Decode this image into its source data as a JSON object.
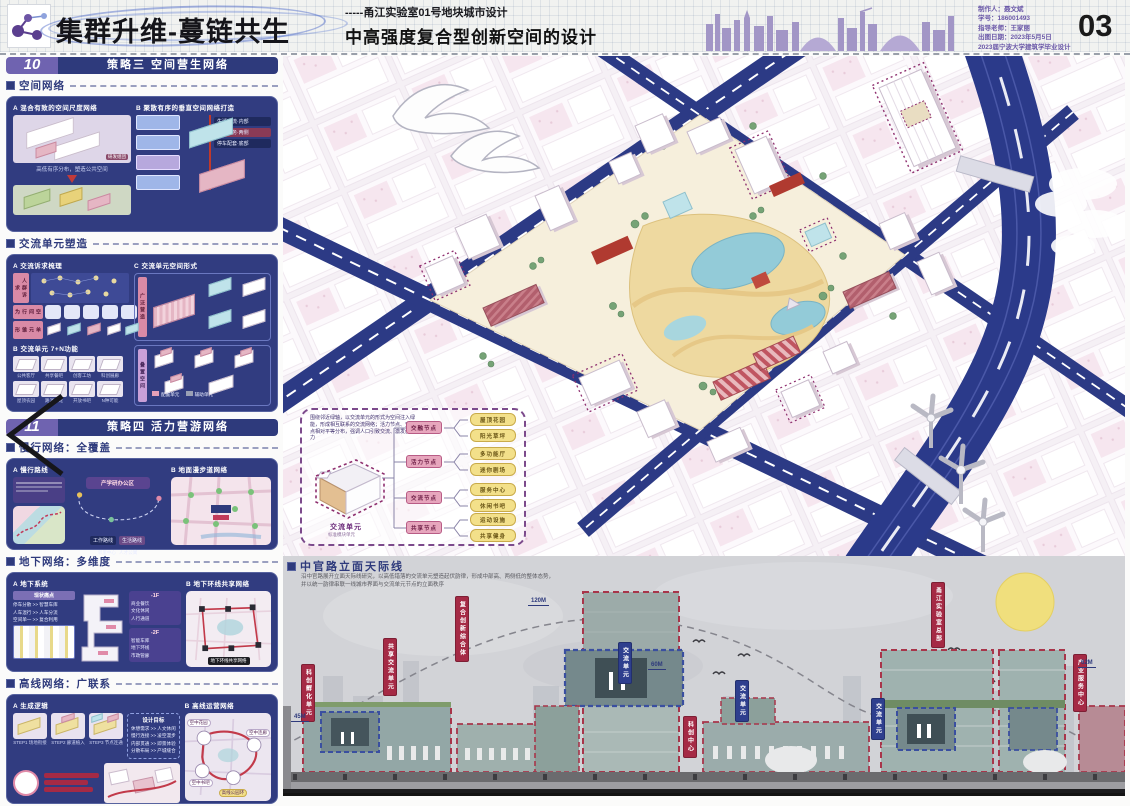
{
  "header": {
    "title": "集群升维-蔓链共生",
    "subtitle_line1": "-----甬江实验室01号地块城市设计",
    "subtitle_line2": "中高强度复合型创新空间的设计",
    "page_number": "03",
    "credits": [
      "制作人：聂文斌",
      "学号：186001493",
      "指导老师：王家丽",
      "出图日期：2023年5月5日",
      "2023届宁波大学建筑学毕业设计"
    ]
  },
  "sidebar": {
    "s10": {
      "num": "10",
      "title": "策略三 空间营生网络",
      "net_label": "空间网络",
      "a_title": "A 混合有致的空间尺度网络",
      "a_caption": "高低有序分布，塑造公共空间",
      "a_tag": "研发组团",
      "b_title": "B 聚散有序的垂直空间网络打造",
      "b_tags": [
        "生活交流·内部",
        "公共服务·两侧",
        "停车配套·底部"
      ],
      "unit_label": "交流单元塑造",
      "c1_title": "A 交流诉求梳理",
      "c1_strips": [
        "人群诉求",
        "空间行为",
        "单元雏形"
      ],
      "c2_title": "B 交流单元 7+N功能",
      "c2_items": [
        "公共客厅",
        "共享餐吧",
        "创客工坊",
        "科创展廊",
        "屋顶农园",
        "路演沙龙",
        "开放书吧",
        "N种可能"
      ],
      "c3_title": "C 交流单元空间形式",
      "c3_strip1": "广泛营造",
      "c3_strip2": "叠置空间",
      "c3_legend1": "配置单元",
      "c3_legend2": "辅助单元"
    },
    "s11": {
      "num": "11",
      "title": "策略四 活力营游网络",
      "walk_label": "慢行网络：全覆盖",
      "walk_a": "A 慢行路线",
      "walk_b": "B 地面漫步道网络",
      "walk_tags": [
        "工作路线",
        "生活路线"
      ],
      "walk_nodes": [
        "产学研办公区",
        "邻里中心",
        "人才公寓"
      ],
      "under_label": "地下网络：多维度",
      "under_a": "A 地下系统",
      "under_b": "B 地下环线共享网络",
      "under_pain": "现状痛点",
      "under_rows": [
        "停车分散 >> 智慧车库",
        "人车混行 >> 人车分流",
        "空间单一 >> 复合利用"
      ],
      "under_f1": "-1F",
      "under_f1_items": [
        "商业餐饮",
        "文化休闲",
        "人行通道"
      ],
      "under_f2": "-2F",
      "under_f2_items": [
        "智能车库",
        "地下环线",
        "市政管廊"
      ],
      "under_map_tag": "地下环线共享网络",
      "high_label": "高线网络：广联系",
      "high_a": "A 生成逻辑",
      "high_b": "B 高线运营网络",
      "high_steps": [
        "STEP1 场地衔接",
        "STEP2 廊道植入",
        "STEP3 节点连通"
      ],
      "high_goal": "设计目标",
      "high_rows": [
        "休憩需求 >> 人文休闲",
        "慢行连接 >> 凌空漫步",
        "内部贯通 >> 即景体验",
        "分散布局 >> 产城缝合"
      ],
      "high_nodes": [
        "空中花园",
        "空中连廊",
        "空中书吧",
        "高线公园环"
      ]
    }
  },
  "axon": {
    "legend": {
      "desc": "围绕邻近绿轴，以交流单元的形式为空间注入绿能，形成相互联系的交流网络；活力节点、交互节点相对平等分布，强调人口引致交流、激发创新活力",
      "unit": "交流单元",
      "unit_sub": "标准模块单元",
      "nodes": [
        "交融节点",
        "活力节点",
        "交流节点",
        "共享节点"
      ],
      "items": [
        "屋顶花园",
        "阳光草坪",
        "多功能厅",
        "迷你剧场",
        "服务中心",
        "休闲书吧",
        "运动设施",
        "共享健身"
      ]
    }
  },
  "skyline": {
    "label": "中官路立面天际线",
    "desc1": "沿中官路展开立面天际线研究，以高低错落的交流单元塑造起伏韵律，形成中部高、两侧低的整体态势，",
    "desc2": "并以统一韵律串联一线城市界面与交流单元节点的立面秩序",
    "red_tags": [
      "科创孵化单元",
      "共享交流单元",
      "复合创新综合体",
      "科创中心",
      "甬江实验室总部",
      "产业服务中心"
    ],
    "blue_tags": [
      "交流单元",
      "交流单元",
      "交流单元"
    ],
    "dims": [
      "120M",
      "45M",
      "60M",
      "62M"
    ]
  }
}
